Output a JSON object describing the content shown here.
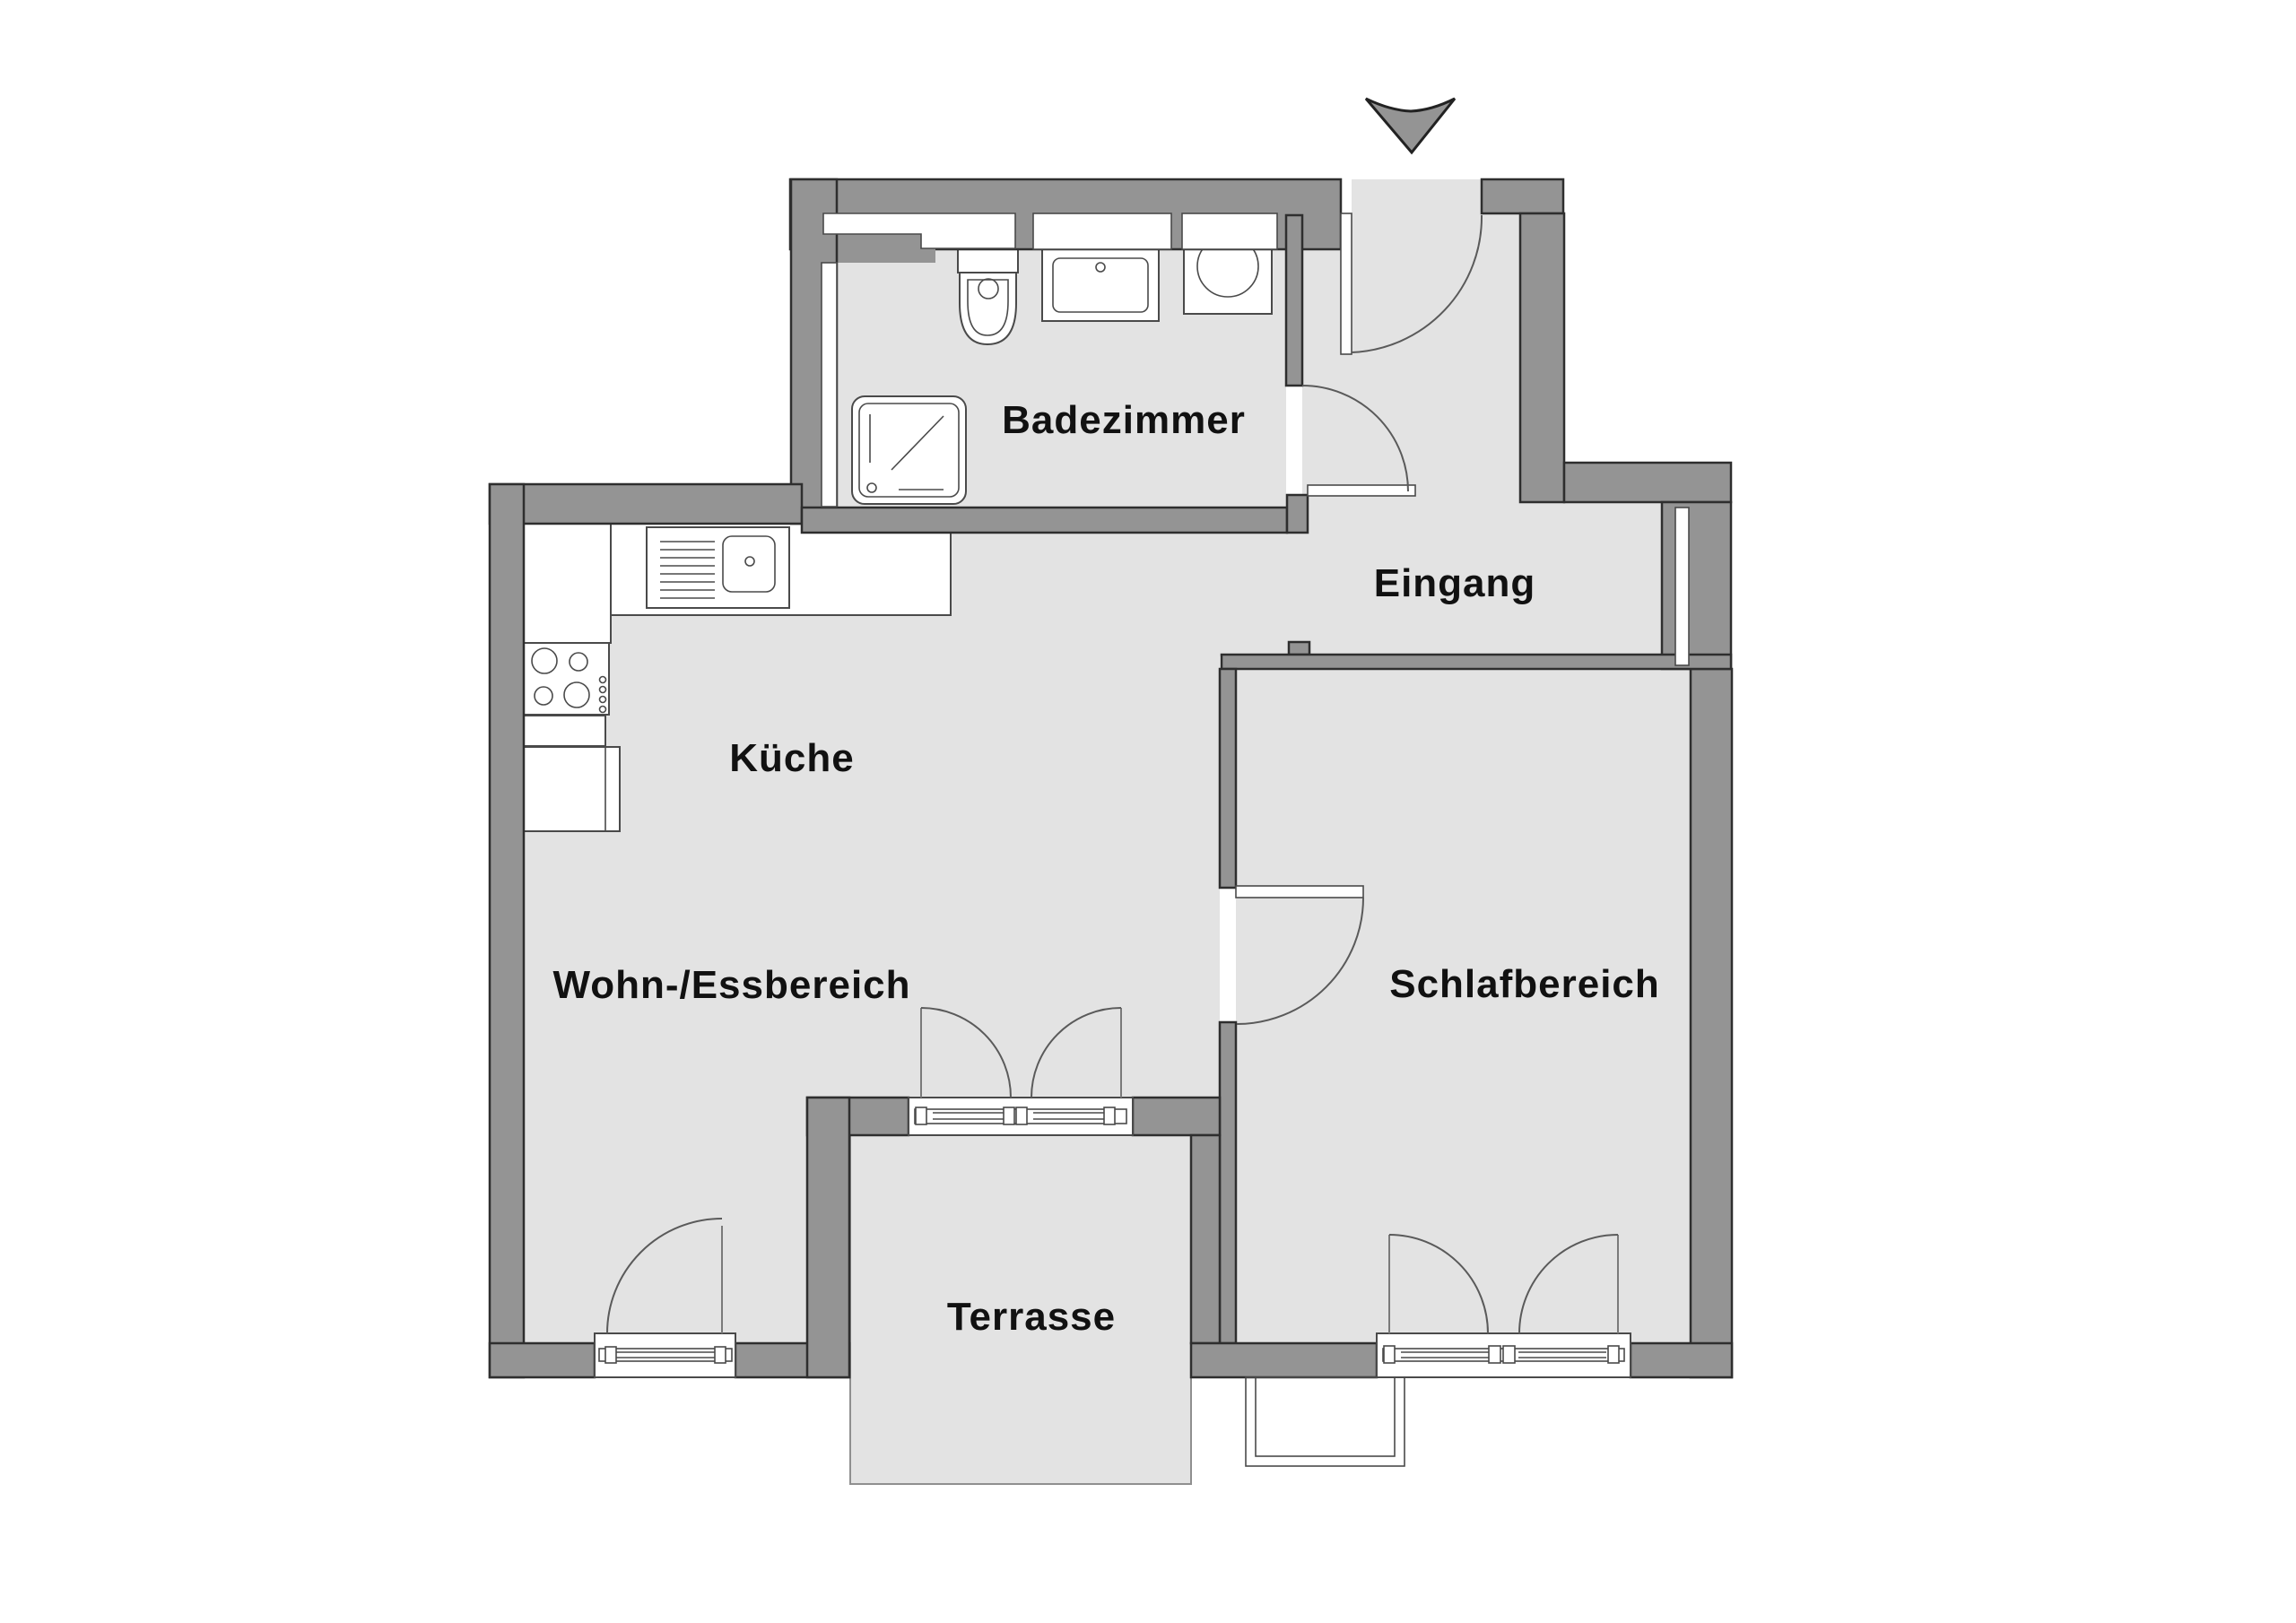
{
  "document": {
    "type": "apartment-floor-plan",
    "language": "de"
  },
  "colors": {
    "background": "#ffffff",
    "wall": "#949494",
    "floor": "#e3e3e3",
    "outline": "#2e2e2e",
    "fixture_line": "#4a4a4a",
    "label_color": "#111111"
  },
  "rooms": {
    "badezimmer": {
      "label": "Badezimmer"
    },
    "eingang": {
      "label": "Eingang"
    },
    "kueche": {
      "label": "Küche"
    },
    "wohn_essbereich": {
      "label": "Wohn-/Essbereich"
    },
    "schlafbereich": {
      "label": "Schlafbereich"
    },
    "terrasse": {
      "label": "Terrasse"
    }
  },
  "icons": [
    "entrance-arrow-icon",
    "shower-icon",
    "toilet-icon",
    "washbasin-icon",
    "washing-machine-icon",
    "kitchen-sink-icon",
    "stove-icon",
    "door-swing-arc",
    "french-door",
    "window",
    "light-shaft"
  ]
}
